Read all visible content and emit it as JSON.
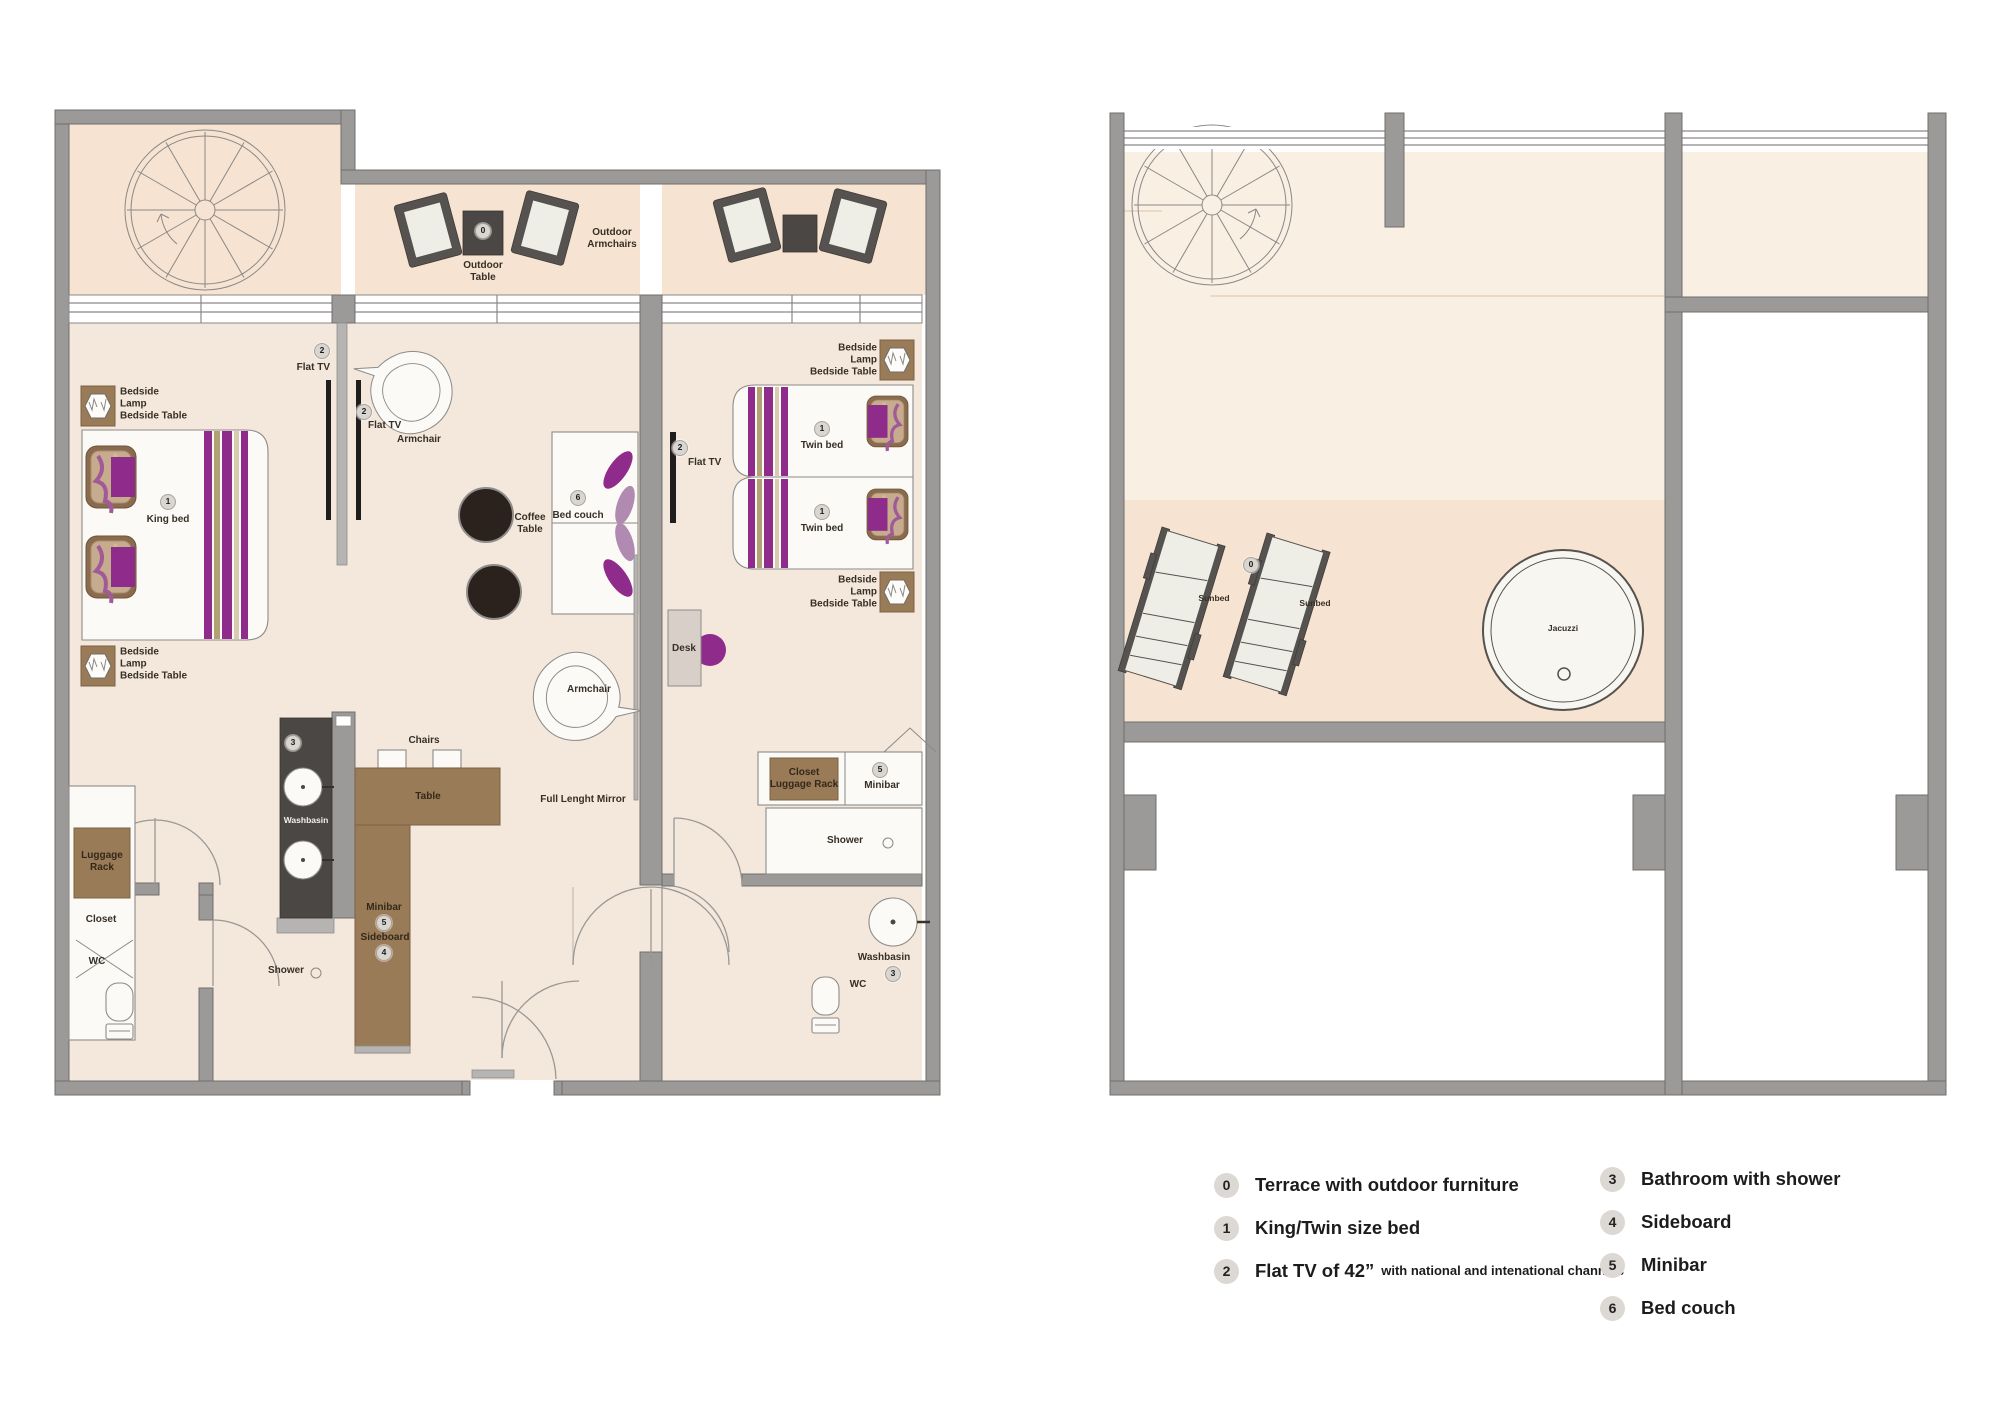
{
  "badges": {
    "terrace": "0",
    "bed": "1",
    "tv": "2",
    "bathroom": "3",
    "sideboard": "4",
    "minibar": "5",
    "bed_couch": "6"
  },
  "plan1": {
    "labels": {
      "king_bed": "King bed",
      "twin_bed": "Twin bed",
      "flat_tv": "Flat TV",
      "armchair": "Armchair",
      "coffee_table": "Coffee Table",
      "bed_couch": "Bed couch",
      "desk": "Desk",
      "chairs": "Chairs",
      "table": "Table",
      "minibar": "Minibar",
      "sideboard": "Sideboard",
      "washbasin": "Washbasin",
      "shower": "Shower",
      "wc": "WC",
      "closet": "Closet",
      "luggage_rack": "Luggage Rack",
      "closet_luggage_rack": "Closet Luggage Rack",
      "bedside": "Bedside Lamp Bedside Table",
      "full_length_mirror": "Full Lenght Mirror",
      "outdoor_table": "Outdoor Table",
      "outdoor_armchairs": "Outdoor Armchairs"
    }
  },
  "plan2": {
    "labels": {
      "sunbed": "Sunbed",
      "jacuzzi": "Jacuzzi"
    }
  },
  "legend": {
    "left": [
      {
        "num": "0",
        "label": "Terrace with outdoor furniture",
        "note": ""
      },
      {
        "num": "1",
        "label": "King/Twin size bed",
        "note": ""
      },
      {
        "num": "2",
        "label": "Flat TV of 42”",
        "note": "with national and intenational channels"
      }
    ],
    "right": [
      {
        "num": "3",
        "label": "Bathroom with shower"
      },
      {
        "num": "4",
        "label": "Sideboard"
      },
      {
        "num": "5",
        "label": "Minibar"
      },
      {
        "num": "6",
        "label": "Bed couch"
      }
    ]
  },
  "colors": {
    "accent_purple": "#8f2b8a",
    "wall_gray": "#9c9a98",
    "floor_interior": "#f4e8dc",
    "floor_terrace": "#f6e3d1",
    "floor_upper": "#f9efe3",
    "furniture_brown": "#9a7b57",
    "counter_dark": "#4b4744",
    "frame_dark": "#55524f"
  }
}
